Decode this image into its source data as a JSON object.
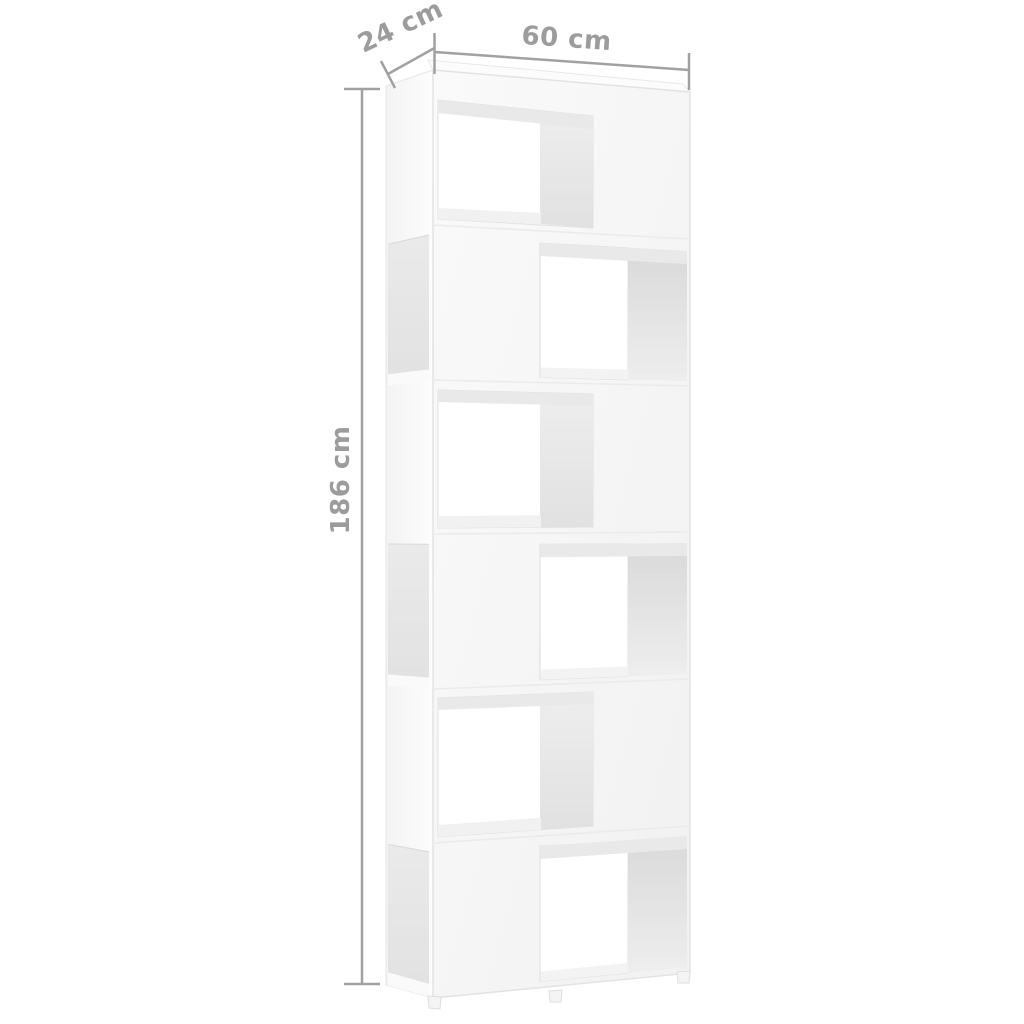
{
  "product_diagram": {
    "dimension_labels": {
      "depth": "24 cm",
      "width": "60 cm",
      "height": "186 cm"
    },
    "shelf": {
      "levels": 6,
      "compartment_pattern": [
        "left",
        "right",
        "left",
        "right",
        "left",
        "right"
      ]
    },
    "colors": {
      "background": "#ffffff",
      "dimension_line": "#a1a1a1",
      "dimension_text": "#9c9c9c",
      "shelf_front": "#f7f7f7",
      "shelf_through_opening": "#ffffff",
      "interior_wall_dark": "#d9d9d9",
      "interior_wall_light": "#ededed",
      "side_opening": "#e7e7e7"
    }
  }
}
